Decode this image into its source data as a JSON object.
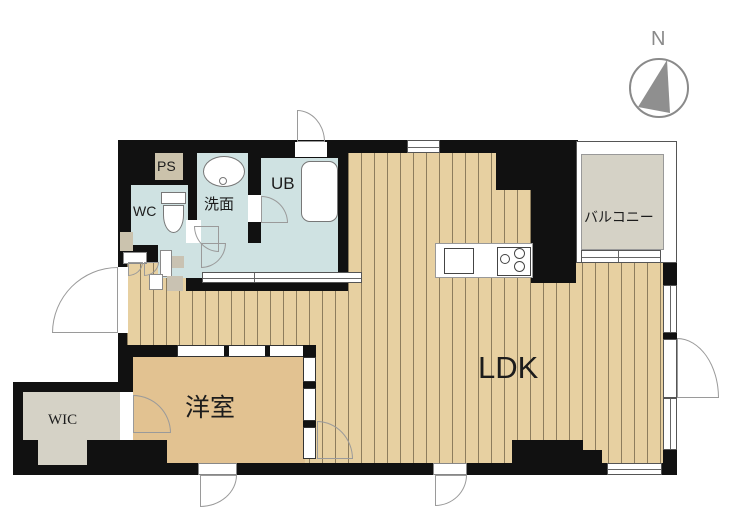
{
  "plan": {
    "compass_label": "N",
    "rooms": {
      "ldk": "LDK",
      "western_room": "洋室",
      "wic": "WIC",
      "balcony": "バルコニー",
      "washroom": "洗面",
      "unit_bath": "UB",
      "toilet": "WC",
      "pipe_space": "PS"
    },
    "colors": {
      "wall": "#111111",
      "flooring": "#e7d0a1",
      "flooring_line": "#8d7d5d",
      "western_room_floor": "#e2c291",
      "wet_area": "#cfe2e2",
      "gray_area": "#d5d2c6",
      "ps_fill": "#cbc2ab",
      "compass": "#8a8a8a"
    }
  }
}
